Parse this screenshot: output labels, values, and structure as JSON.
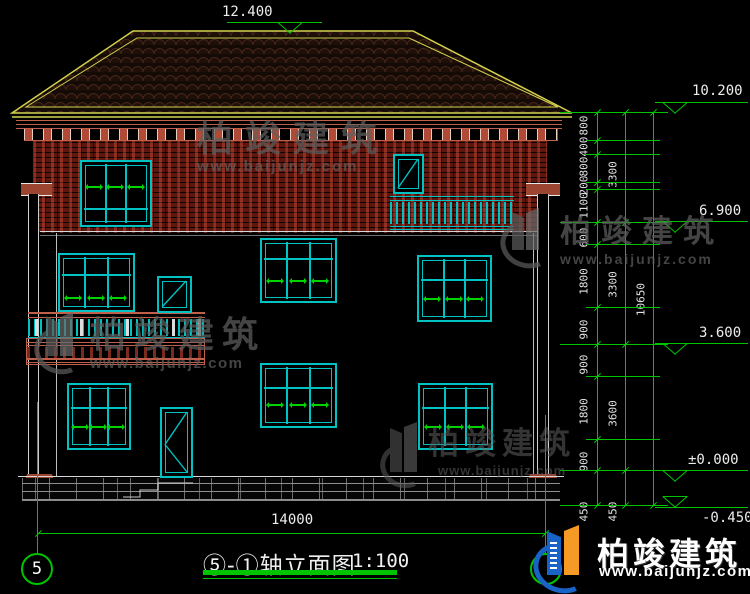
{
  "colors": {
    "background": "#000000",
    "cad_green": "#00c400",
    "cad_teal": "#00c2c2",
    "roof_yellow": "#d2d24e",
    "brick_red": "#6e1c12",
    "cornice_red": "#c0604a",
    "text_white": "#ececec",
    "watermark_gray": "#5f5f5f",
    "logo_blue": "#1a63c6",
    "logo_orange": "#f59b25"
  },
  "annotations": {
    "bottom_dimension": "14000",
    "axis_left_bubble": "5",
    "title": "⑤-①轴立面图",
    "scale": "1:100"
  },
  "elevation_markers": [
    {
      "label": "12.400",
      "x1": 227,
      "x2": 322,
      "y": 22,
      "tri_x": 278,
      "text_x": 222,
      "text_y": 4,
      "above": false
    },
    {
      "label": "10.200",
      "x1": 655,
      "x2": 748,
      "y": 102,
      "tri_x": 663,
      "text_x": 692,
      "text_y": 83,
      "above": false
    },
    {
      "label": "6.900",
      "x1": 655,
      "x2": 748,
      "y": 221,
      "tri_x": 663,
      "text_x": 699,
      "text_y": 203,
      "above": false
    },
    {
      "label": "3.600",
      "x1": 655,
      "x2": 748,
      "y": 343,
      "tri_x": 663,
      "text_x": 699,
      "text_y": 325,
      "above": false
    },
    {
      "label": "±0.000",
      "x1": 655,
      "x2": 748,
      "y": 470,
      "tri_x": 663,
      "text_x": 688,
      "text_y": 452,
      "above": false
    },
    {
      "label": "-0.450",
      "x1": 655,
      "x2": 748,
      "y": 507,
      "tri_x": 663,
      "text_x": 702,
      "text_y": 510,
      "above": true
    }
  ],
  "dim_chains": [
    {
      "x": 597,
      "y1": 112,
      "y2": 505,
      "label_x": 584,
      "ticks": [
        112,
        140,
        154,
        182,
        189,
        222,
        244,
        307,
        344,
        376,
        439,
        470,
        505
      ],
      "labels": [
        {
          "t": "800",
          "y": 126
        },
        {
          "t": "400",
          "y": 147
        },
        {
          "t": "800",
          "y": 167
        },
        {
          "t": "200",
          "y": 186
        },
        {
          "t": "1100",
          "y": 206
        },
        {
          "t": "600",
          "y": 238
        },
        {
          "t": "1800",
          "y": 282
        },
        {
          "t": "900",
          "y": 330
        },
        {
          "t": "900",
          "y": 365
        },
        {
          "t": "1800",
          "y": 412
        },
        {
          "t": "900",
          "y": 462
        },
        {
          "t": "450",
          "y": 512
        }
      ]
    },
    {
      "x": 625,
      "y1": 112,
      "y2": 505,
      "label_x": 613,
      "ticks": [
        112,
        222,
        344,
        470,
        505
      ],
      "labels": [
        {
          "t": "3300",
          "y": 175
        },
        {
          "t": "3300",
          "y": 285
        },
        {
          "t": "3600",
          "y": 414
        },
        {
          "t": "450",
          "y": 512
        }
      ]
    },
    {
      "x": 653,
      "y1": 112,
      "y2": 505,
      "label_x": 641,
      "ticks": [
        112,
        505
      ],
      "labels": [
        {
          "t": "10650",
          "y": 300
        }
      ]
    }
  ],
  "watermark": {
    "brand": "柏竣建筑",
    "site": "www.baijunjz.com"
  },
  "footer": {
    "brand": "柏竣建筑",
    "site": "www.baijunjz.com"
  }
}
